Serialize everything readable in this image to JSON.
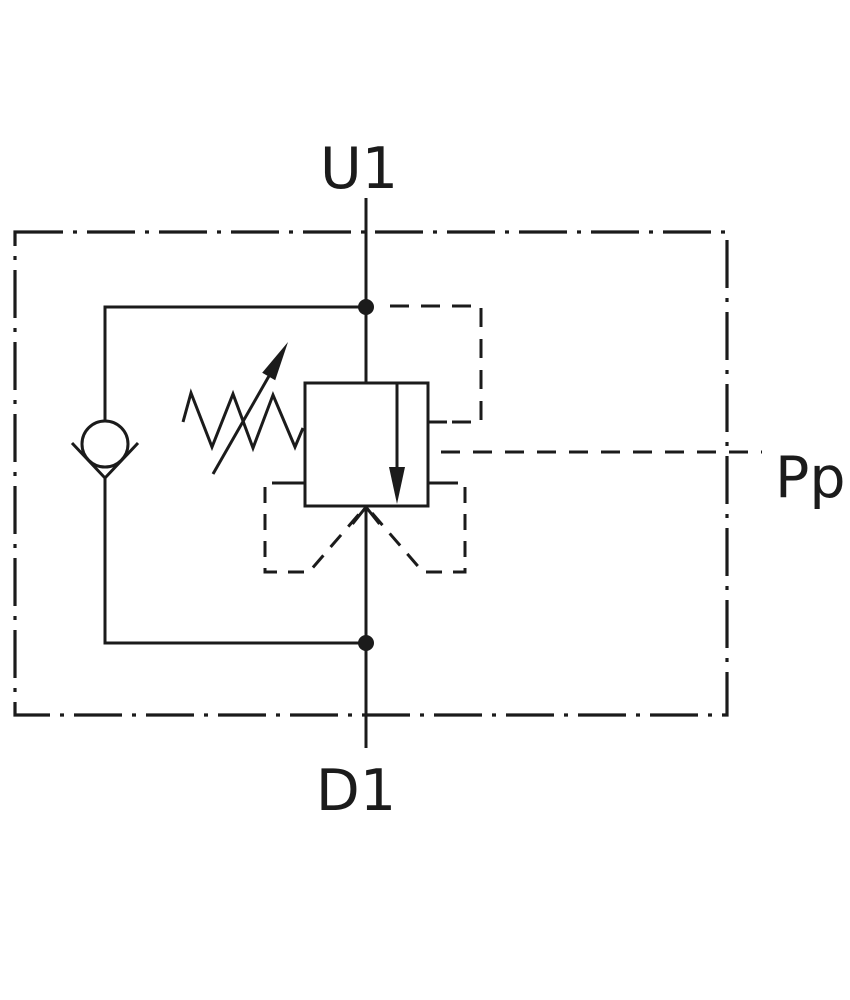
{
  "colors": {
    "background": "#ffffff",
    "line": "#1b1b1b"
  },
  "schematic": {
    "ports": {
      "upstream": {
        "label": "U1"
      },
      "downstream": {
        "label": "D1"
      },
      "pilot": {
        "label": "Pp"
      }
    },
    "symbols": {
      "boundary": "dash-dot-enclosure",
      "main_valve": "pressure-valve-square-symbol",
      "flow_arrow": "downward-flow-arrow",
      "inlet_arrow": "open-arrowhead-up",
      "spring": "adjustable-spring-zigzag",
      "adjustment": "diagonal-adjustment-arrow",
      "check_valve": "ball-check-valve",
      "junctions": "connection-dots",
      "pilot_lines": "dashed-pilot-lines",
      "vent": "dashed-vent-vee"
    }
  }
}
